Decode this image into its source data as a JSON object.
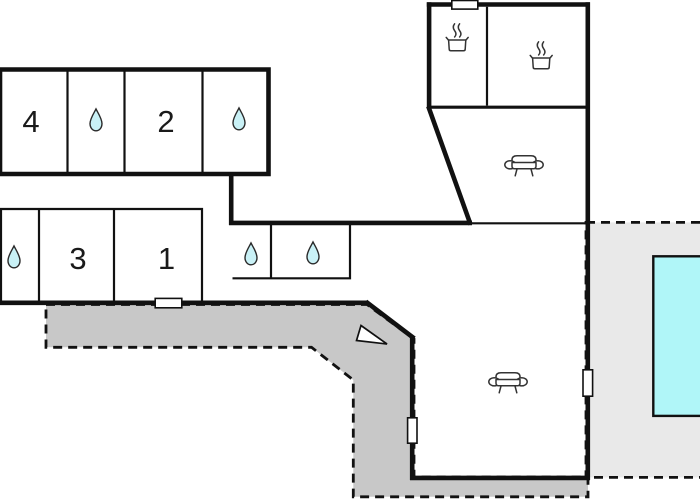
{
  "colors": {
    "background": "#ffffff",
    "wall": "#111111",
    "terrace": "#c8c8c8",
    "pool_deck": "#e9e9e9",
    "pool_water": "#b0f6f8",
    "water_drop": "#c9f1f6",
    "icon_stroke": "#333333",
    "room_text": "#1a1a1a"
  },
  "rooms": [
    {
      "id": "bedroom-4",
      "label": "4"
    },
    {
      "id": "bedroom-2",
      "label": "2"
    },
    {
      "id": "bedroom-3",
      "label": "3"
    },
    {
      "id": "bedroom-1",
      "label": "1"
    }
  ],
  "icons": {
    "water_drop": {
      "name": "water-drop-icon",
      "meaning": "bathroom",
      "count": 5
    },
    "cooking_pot": {
      "name": "cooking-pot-icon",
      "meaning": "kitchen",
      "count": 2
    },
    "sofa": {
      "name": "sofa-icon",
      "meaning": "living-area",
      "count": 2
    },
    "north_arrow": {
      "name": "north-arrow-icon",
      "meaning": "orientation",
      "count": 1
    },
    "window_door": {
      "name": "window-door-marker",
      "count": 4
    }
  },
  "areas": {
    "terrace": {
      "style": "dashed-outline",
      "fill": "dark-gray"
    },
    "pool_deck": {
      "style": "dashed-outline",
      "fill": "light-gray"
    },
    "swimming_pool": {
      "fill": "cyan"
    }
  }
}
